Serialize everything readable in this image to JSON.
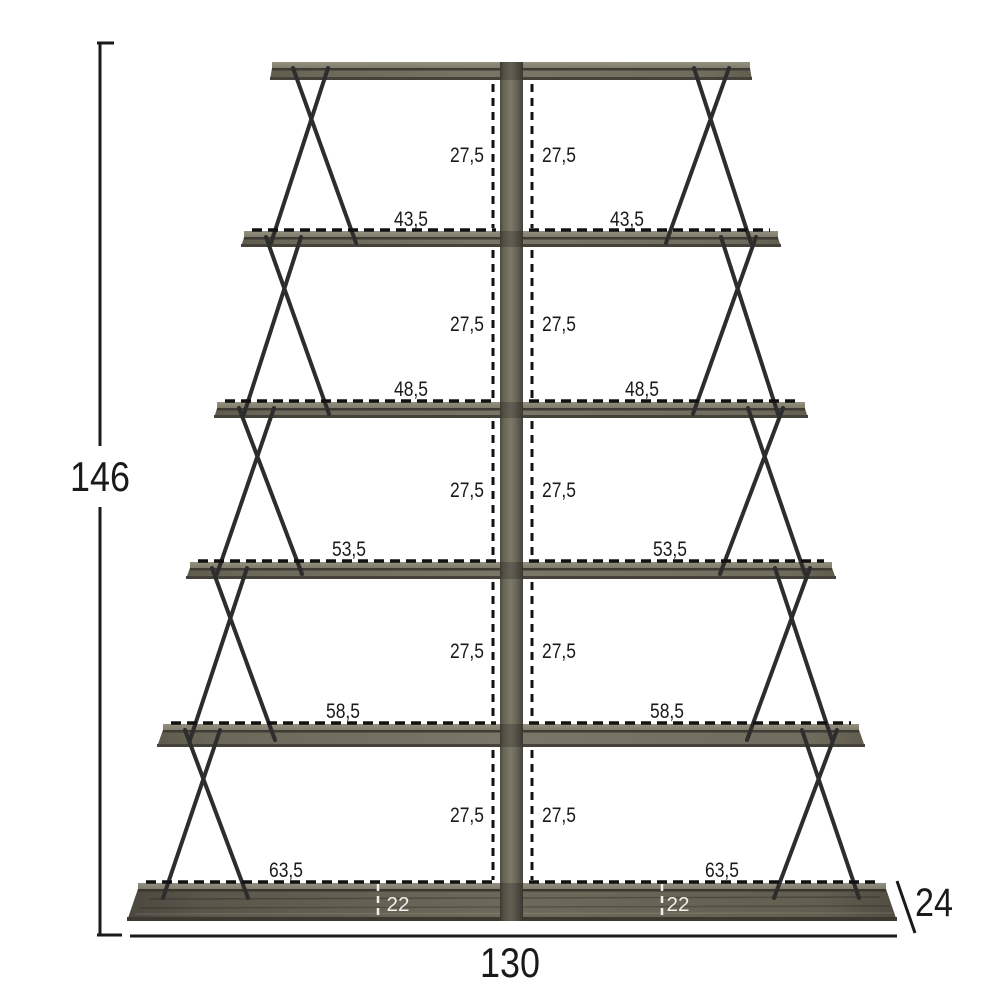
{
  "diagram": {
    "overall": {
      "height": "146",
      "width": "130",
      "depth": "24"
    },
    "base_inset": "22",
    "rows": [
      {
        "gap": "27,5",
        "width": "43,5"
      },
      {
        "gap": "27,5",
        "width": "48,5"
      },
      {
        "gap": "27,5",
        "width": "53,5"
      },
      {
        "gap": "27,5",
        "width": "58,5"
      },
      {
        "gap": "27,5",
        "width": "63,5"
      }
    ],
    "colors": {
      "board_face": "#6e6a5d",
      "board_top": "#8b887b",
      "base_face": "#5f5b4d",
      "wire": "#2d2d2d",
      "dimension_line": "#1a1a1a",
      "inset_label": "#f0efec",
      "background": "#ffffff"
    }
  }
}
